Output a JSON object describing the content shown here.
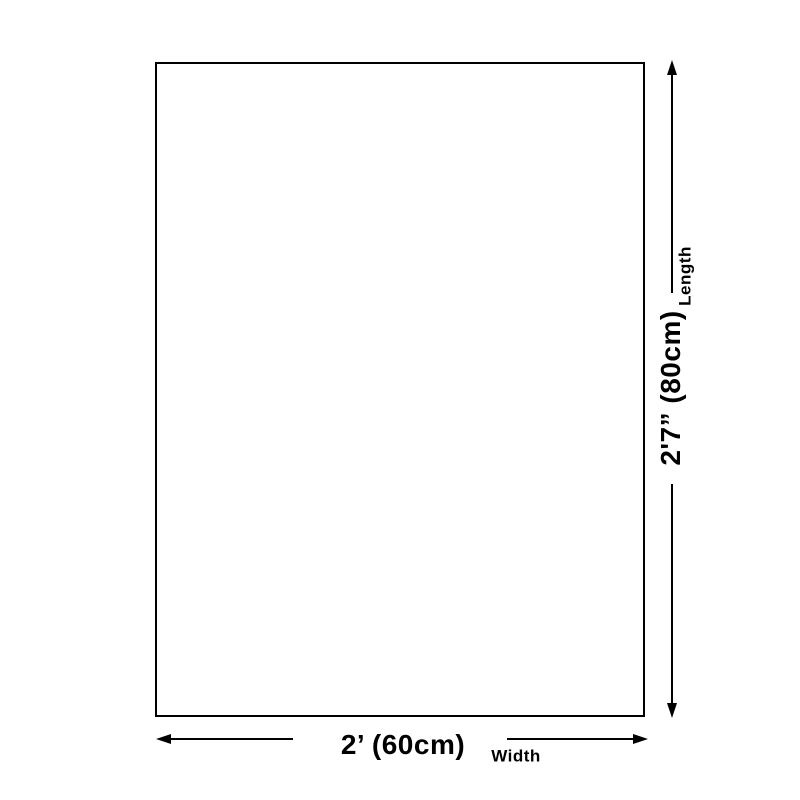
{
  "diagram": {
    "type": "product-size-diagram",
    "colors": {
      "background": "#ffffff",
      "line": "#000000",
      "text": "#000000"
    },
    "dimensions": {
      "length": {
        "label": "Length",
        "value": "2'7” (80cm)"
      },
      "width": {
        "label": "Width",
        "value": "2’ (60cm)"
      }
    },
    "icons": [
      "arrow-up-icon",
      "arrow-down-icon",
      "arrow-left-icon",
      "arrow-right-icon"
    ]
  }
}
